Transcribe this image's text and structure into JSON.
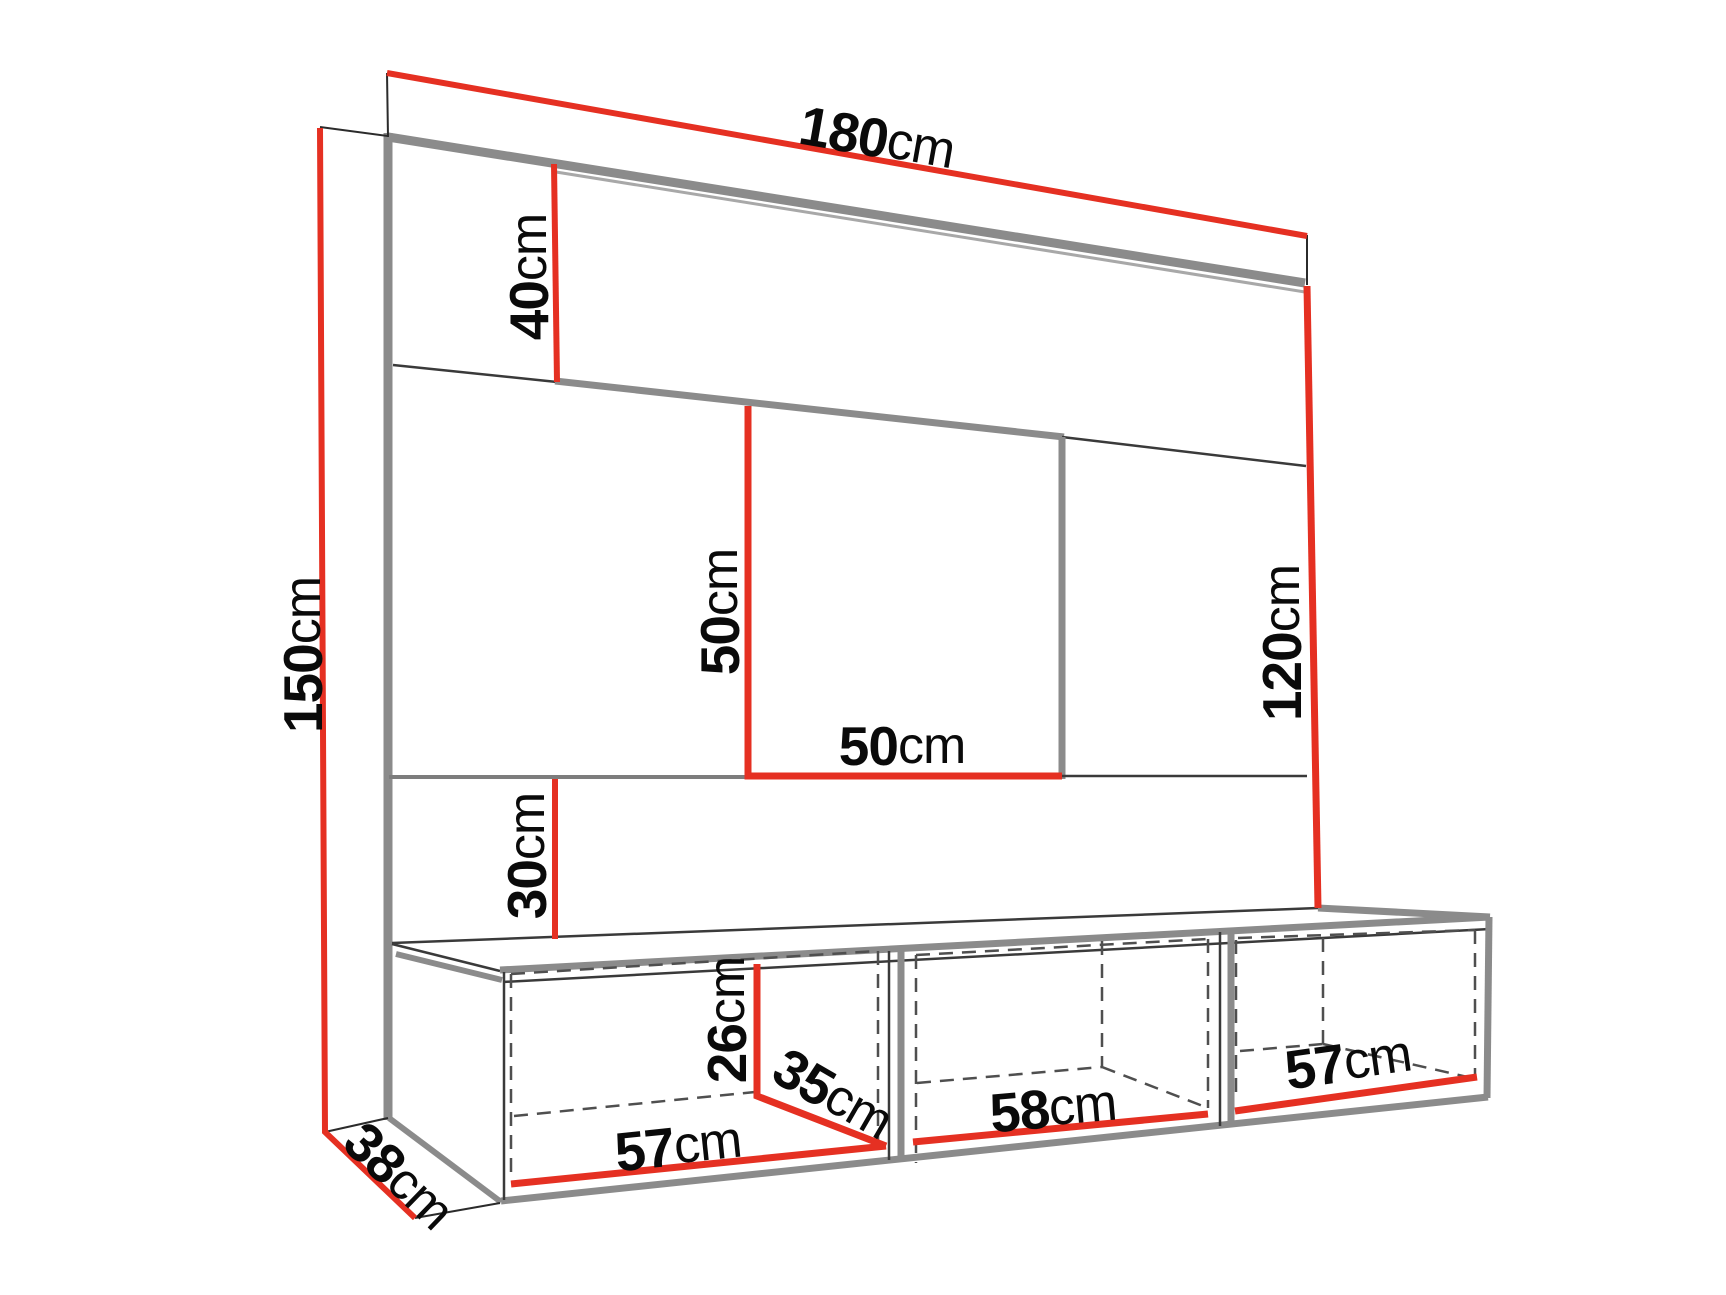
{
  "diagram": {
    "type": "furniture-dimension-diagram",
    "subject": "Wall-mounted TV panel with three open cabinets",
    "unit": "cm",
    "colors": {
      "dimension_line": "#e53022",
      "structure_line": "#8b8b8b",
      "thin_line": "#2b2b2b",
      "hidden_line": "#4f4f4f",
      "background": "#ffffff",
      "text": "#0a0a0a"
    },
    "dims": {
      "total_width": {
        "value": "180",
        "unit": "cm"
      },
      "total_height": {
        "value": "150",
        "unit": "cm"
      },
      "top_panel_height": {
        "value": "40",
        "unit": "cm"
      },
      "recess_height": {
        "value": "50",
        "unit": "cm"
      },
      "recess_width": {
        "value": "50",
        "unit": "cm"
      },
      "right_panel_height": {
        "value": "120",
        "unit": "cm"
      },
      "bottom_panel_height": {
        "value": "30",
        "unit": "cm"
      },
      "cabinet_inner_height": {
        "value": "26",
        "unit": "cm"
      },
      "cabinet_inner_depth": {
        "value": "35",
        "unit": "cm"
      },
      "cabinet_left_width": {
        "value": "57",
        "unit": "cm"
      },
      "cabinet_middle_width": {
        "value": "58",
        "unit": "cm"
      },
      "cabinet_right_width": {
        "value": "57",
        "unit": "cm"
      },
      "base_depth": {
        "value": "38",
        "unit": "cm"
      }
    }
  }
}
